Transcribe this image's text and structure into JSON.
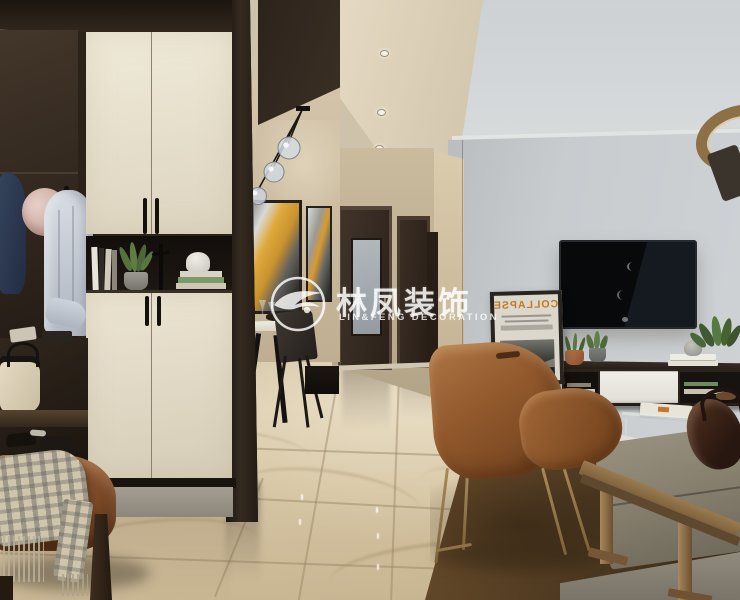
{
  "watermark": {
    "brand_cn": "林凤装饰",
    "brand_en": "LIN&FENG DECORATION",
    "color": "#ffffff"
  },
  "poster": {
    "title": "COLLAPSE",
    "mirrored": true,
    "title_color": "#c07a20"
  },
  "lighting": {
    "hall_downlights": 3,
    "pendant_globes": 3,
    "ring_pendant": 1
  },
  "palette": {
    "dark_wood": "#2a211a",
    "cabinet_cream": "#e9e2cf",
    "wall_beige": "#c9bba1",
    "wall_gray": "#c6cacd",
    "ceiling_warm": "#ddd1ba",
    "ceiling_cool": "#d5d8da",
    "floor_marble": "#d3c4a5",
    "leather_chair": "#9a6334",
    "rug_brown": "#5f462b",
    "sofa_gray": "#8b8476",
    "brass": "#9a7a50",
    "coat_navy": "#2e3c58",
    "hat_pink": "#d8bcb4"
  },
  "scene": {
    "areas": [
      "entry-wardrobe",
      "dining-nook",
      "hallway",
      "living-room"
    ],
    "objects": [
      "wardrobe-cabinet",
      "coat-nook",
      "navy-coat",
      "sun-hat",
      "white-shirt",
      "display-niche",
      "books",
      "potted-succulent",
      "figure-sculpture",
      "handbag",
      "shoes",
      "leather-bench",
      "plaid-blanket",
      "pendant-globes",
      "wall-art-abstract",
      "dining-table",
      "dining-chair",
      "hallway-doors",
      "frosted-glass-door",
      "wall-tv",
      "tv-stand",
      "collapse-poster",
      "copper-planter",
      "gray-planter",
      "leather-armchair",
      "area-rug",
      "fabric-sofa",
      "leather-bag",
      "glass-side-table",
      "wood-slab-table",
      "ring-pendant-lamp",
      "marble-floor"
    ]
  }
}
